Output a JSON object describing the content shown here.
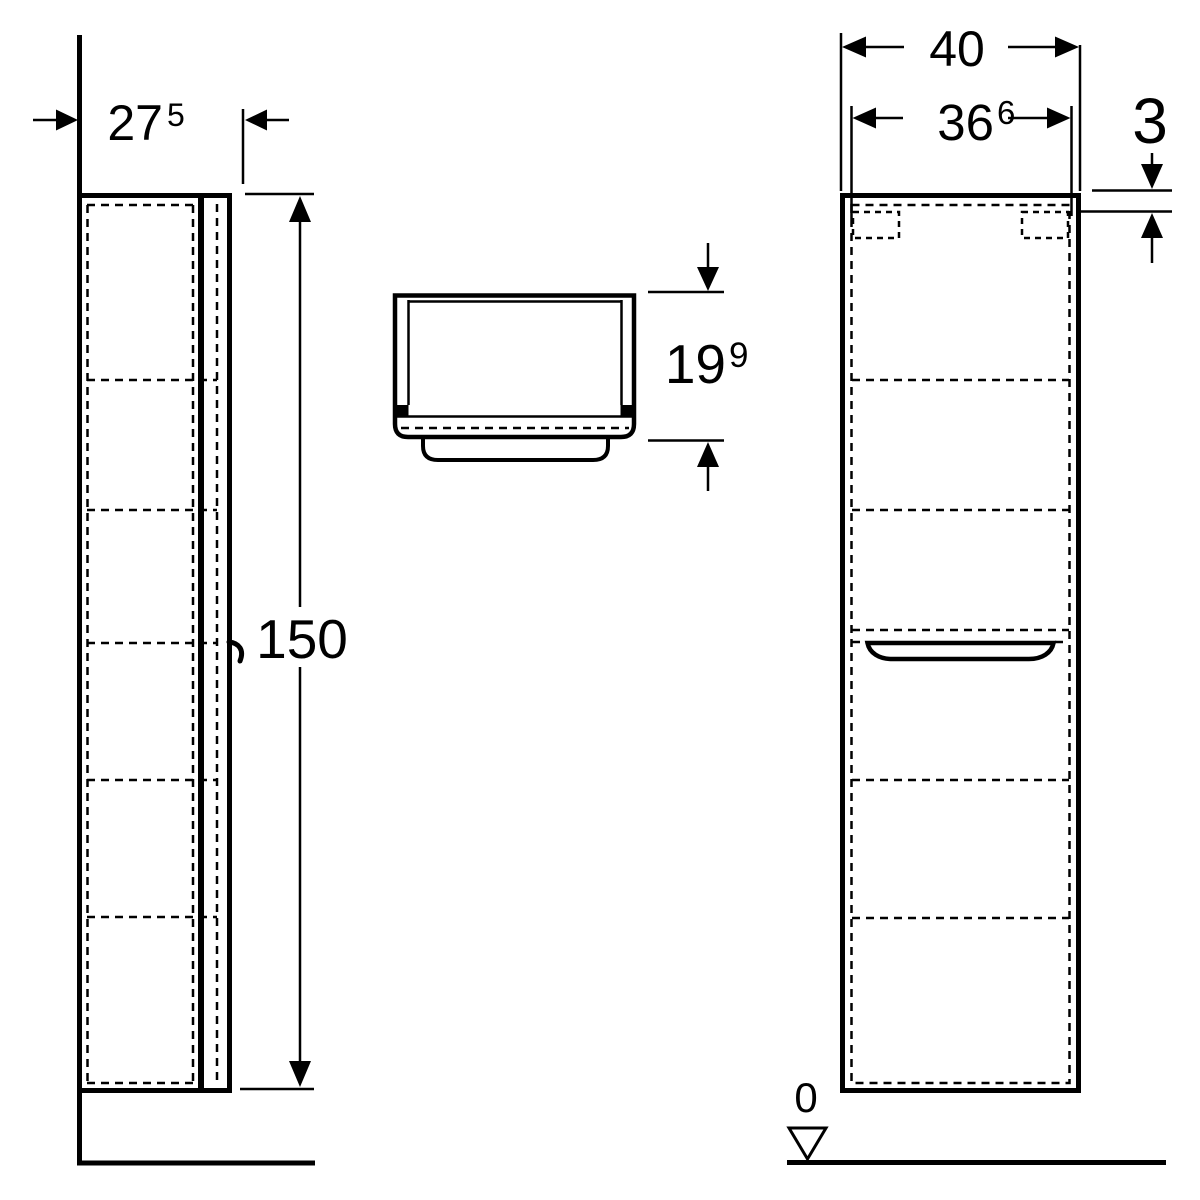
{
  "dims": {
    "depth": {
      "main": "27",
      "sup": "5"
    },
    "height": {
      "value": "150"
    },
    "plan_depth": {
      "main": "19",
      "sup": "9"
    },
    "width": {
      "value": "40"
    },
    "inner_width": {
      "main": "36",
      "sup": "6"
    },
    "top_thickness": {
      "value": "3"
    },
    "floor_level": {
      "value": "0"
    }
  },
  "colors": {
    "line": "#000000",
    "background": "#ffffff"
  }
}
